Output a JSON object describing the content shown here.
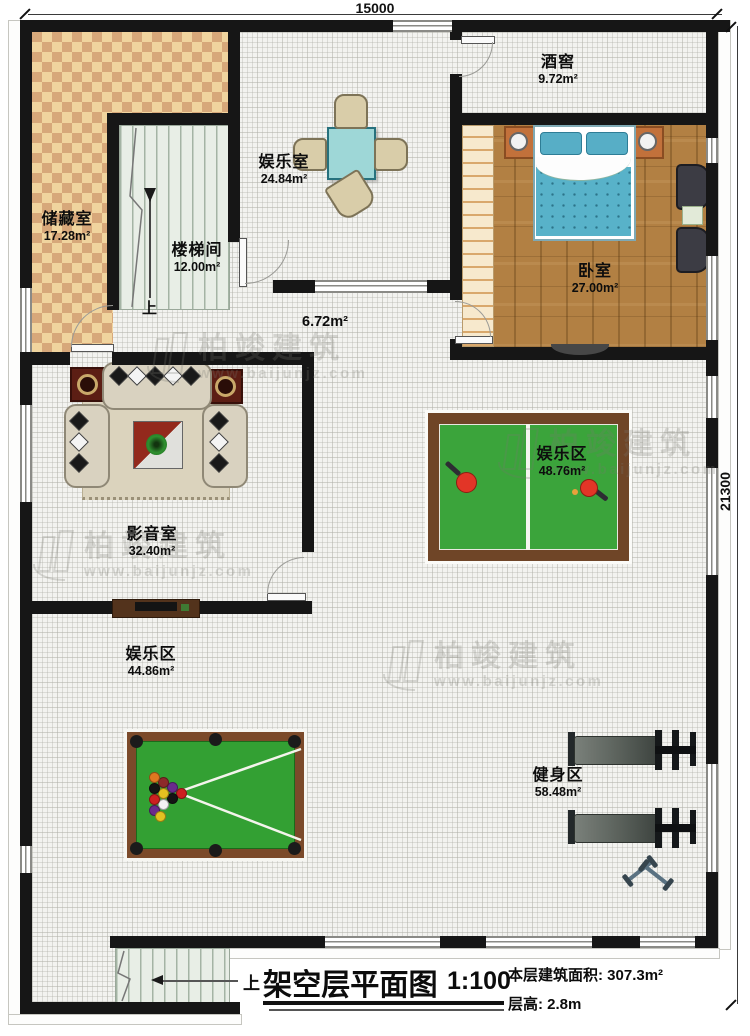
{
  "plan": {
    "dimensions": {
      "width_mm": "15000",
      "height_mm": "21300"
    },
    "rooms": [
      {
        "name": "储藏室",
        "area": "17.28m²"
      },
      {
        "name": "楼梯间",
        "area": "12.00m²"
      },
      {
        "name": "娱乐室",
        "area": "24.84m²"
      },
      {
        "name": "酒窖",
        "area": "9.72m²"
      },
      {
        "name": "卧室",
        "area": "27.00m²"
      },
      {
        "name": "影音室",
        "area": "32.40m²"
      },
      {
        "name": "娱乐区",
        "area": "48.76m²"
      },
      {
        "name": "娱乐区",
        "area": "44.86m²"
      },
      {
        "name": "健身区",
        "area": "58.48m²"
      }
    ],
    "corridor_area": "6.72m²",
    "stair_up_label": "上",
    "exterior_stair_up_label": "上"
  },
  "title_block": {
    "title": "架空层平面图",
    "scale": "1:100",
    "floor_area_label": "本层建筑面积:",
    "floor_area_value": "307.3m²",
    "floor_height_label": "层高:",
    "floor_height_value": "2.8m"
  },
  "watermark": {
    "brand": "柏竣建筑",
    "url": "www.baijunjz.com"
  },
  "colors": {
    "wall": "#161616",
    "checker_light": "#f0d49e",
    "checker_dark": "#d7a87a",
    "wood_floor": "#b28043",
    "table_teal": "#9ed7d7",
    "pool_felt_green": "#33a033",
    "pingpong_green": "#3ba43b",
    "frame_brown": "#7b4a2a",
    "paddle_red": "#e23527",
    "bed_blue": "#58b2c9",
    "speaker_red": "#5c1e14"
  }
}
